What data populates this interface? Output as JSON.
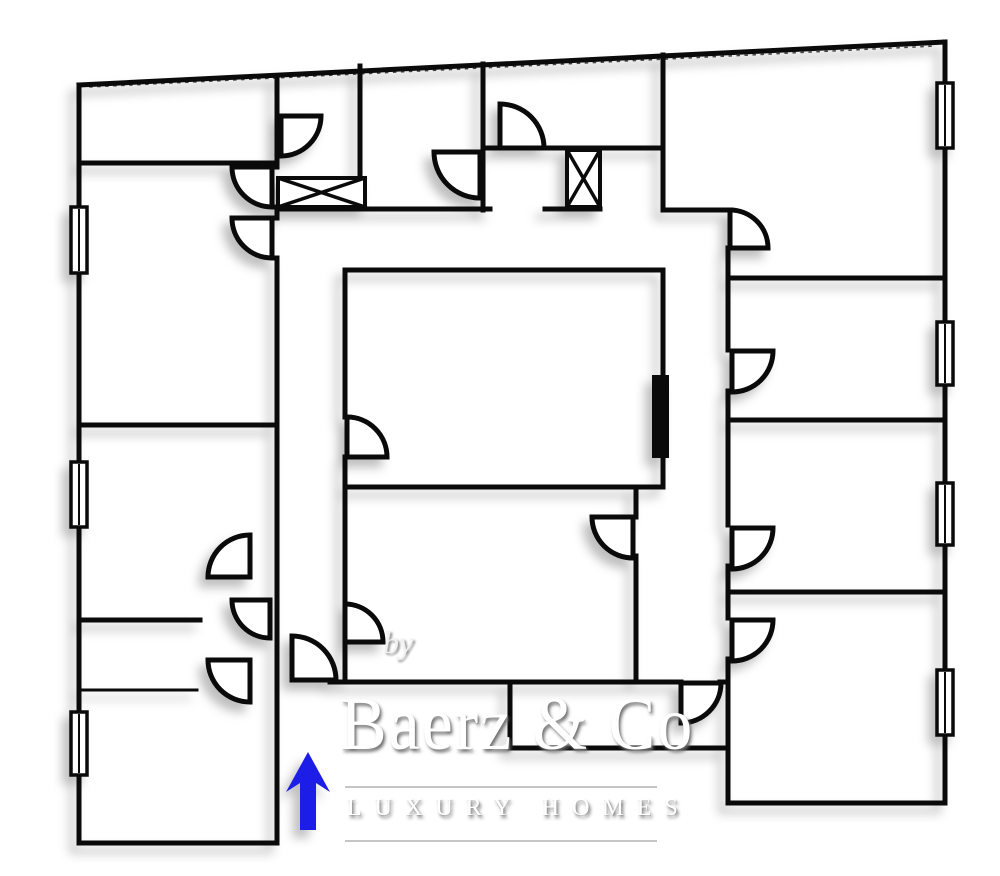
{
  "watermark": {
    "by": "by",
    "brand": "Baerz & Co",
    "tagline": "LUXURY HOMES",
    "rule_color": "#9a9a9a"
  },
  "plan": {
    "stroke_color": "#0a0a0a",
    "wall_width": 5,
    "thin_wall_width": 3,
    "walls": [
      [
        79,
        85,
        945,
        42
      ],
      [
        945,
        42,
        945,
        803
      ],
      [
        728,
        803,
        945,
        803
      ],
      [
        79,
        85,
        79,
        843
      ],
      [
        79,
        843,
        277,
        843
      ],
      [
        79,
        163,
        277,
        163
      ],
      [
        79,
        425,
        277,
        425
      ],
      [
        79,
        620,
        200,
        620
      ],
      [
        277,
        78,
        277,
        167
      ],
      [
        277,
        207,
        277,
        218
      ],
      [
        277,
        258,
        277,
        843
      ],
      [
        360,
        66,
        360,
        178
      ],
      [
        483,
        64,
        483,
        210
      ],
      [
        483,
        148,
        500,
        148
      ],
      [
        544,
        148,
        663,
        148
      ],
      [
        663,
        55,
        663,
        210
      ],
      [
        277,
        209,
        490,
        209
      ],
      [
        545,
        209,
        600,
        209
      ],
      [
        663,
        210,
        730,
        210
      ],
      [
        728,
        248,
        728,
        350
      ],
      [
        728,
        391,
        728,
        525
      ],
      [
        728,
        566,
        728,
        618
      ],
      [
        728,
        659,
        728,
        803
      ],
      [
        728,
        278,
        945,
        278
      ],
      [
        728,
        420,
        945,
        420
      ],
      [
        728,
        592,
        945,
        592
      ],
      [
        345,
        270,
        663,
        270
      ],
      [
        345,
        270,
        345,
        417
      ],
      [
        345,
        457,
        345,
        604
      ],
      [
        345,
        642,
        345,
        682
      ],
      [
        663,
        270,
        663,
        487
      ],
      [
        345,
        487,
        663,
        487
      ],
      [
        636,
        487,
        636,
        517
      ],
      [
        636,
        556,
        636,
        682
      ],
      [
        330,
        682,
        681,
        682
      ],
      [
        720,
        682,
        728,
        682
      ],
      [
        510,
        685,
        510,
        748
      ],
      [
        510,
        748,
        728,
        748
      ]
    ],
    "thin_walls": [
      [
        79,
        690,
        197,
        690
      ]
    ],
    "top_tick_line": [
      90,
      87,
      935,
      46
    ],
    "doors": [
      {
        "px": 272,
        "py": 167,
        "r": 40,
        "leaf": "W",
        "end": "S"
      },
      {
        "px": 272,
        "py": 218,
        "r": 40,
        "leaf": "W",
        "end": "S"
      },
      {
        "px": 281,
        "py": 116,
        "r": 40,
        "leaf": "E",
        "end": "S"
      },
      {
        "px": 480,
        "py": 152,
        "r": 46,
        "leaf": "W",
        "end": "S"
      },
      {
        "px": 500,
        "py": 148,
        "r": 44,
        "leaf": "N",
        "end": "E"
      },
      {
        "px": 730,
        "py": 248,
        "r": 38,
        "leaf": "E",
        "end": "N"
      },
      {
        "px": 732,
        "py": 351,
        "r": 41,
        "leaf": "E",
        "end": "S"
      },
      {
        "px": 732,
        "py": 528,
        "r": 41,
        "leaf": "E",
        "end": "S"
      },
      {
        "px": 732,
        "py": 620,
        "r": 41,
        "leaf": "E",
        "end": "S"
      },
      {
        "px": 633,
        "py": 517,
        "r": 41,
        "leaf": "W",
        "end": "S"
      },
      {
        "px": 347,
        "py": 457,
        "r": 40,
        "leaf": "E",
        "end": "N"
      },
      {
        "px": 345,
        "py": 642,
        "r": 38,
        "leaf": "E",
        "end": "N"
      },
      {
        "px": 681,
        "py": 683,
        "r": 40,
        "leaf": "S",
        "end": "E"
      },
      {
        "px": 292,
        "py": 680,
        "r": 44,
        "leaf": "N",
        "end": "E"
      },
      {
        "px": 250,
        "py": 577,
        "r": 42,
        "leaf": "N",
        "end": "W"
      },
      {
        "px": 270,
        "py": 600,
        "r": 38,
        "leaf": "W",
        "end": "S"
      },
      {
        "px": 250,
        "py": 660,
        "r": 42,
        "leaf": "S",
        "end": "W"
      }
    ],
    "windows": [
      [
        71,
        207,
        16,
        66
      ],
      [
        71,
        462,
        16,
        65
      ],
      [
        71,
        712,
        16,
        63
      ],
      [
        937,
        83,
        16,
        65
      ],
      [
        937,
        322,
        16,
        63
      ],
      [
        937,
        483,
        16,
        62
      ],
      [
        937,
        670,
        16,
        65
      ]
    ],
    "x_boxes": [
      [
        278,
        178,
        87,
        29
      ],
      [
        567,
        150,
        33,
        57
      ]
    ],
    "solid_rects": [
      [
        652,
        375,
        17,
        83
      ]
    ],
    "entry_arrow": {
      "color": "#1d1de8",
      "points": "308,752 330,792 316,783 316,830 300,830 300,783 286,792"
    }
  }
}
